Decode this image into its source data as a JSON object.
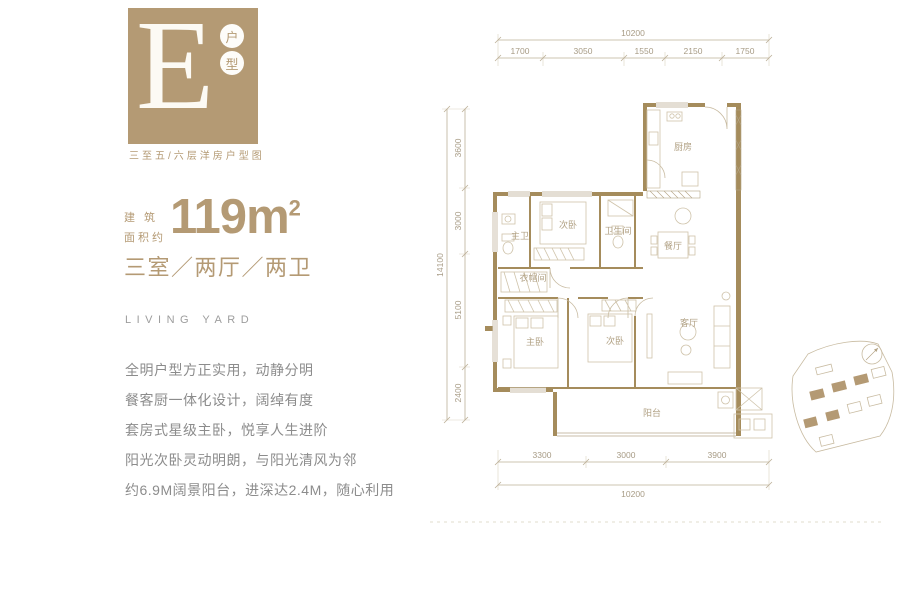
{
  "brand": {
    "letter": "E",
    "type_chars": [
      "户",
      "型"
    ],
    "subtitle": "三至五/六层洋房户型图"
  },
  "summary": {
    "area_prefix_line1": "建 筑",
    "area_prefix_line2": "面积约",
    "area_value": "119",
    "area_unit": "m",
    "area_sup": "2",
    "layout": "三室／两厅／两卫",
    "english": "LIVING YARD"
  },
  "features": [
    "全明户型方正实用，动静分明",
    "餐客厨一体化设计，阔绰有度",
    "套房式星级主卧，悦享人生进阶",
    "阳光次卧灵动明朗，与阳光清风为邻",
    "约6.9M阔景阳台，进深达2.4M，随心利用"
  ],
  "plan": {
    "rooms": {
      "kitchen": "厨房",
      "bedroom_top": "次卧",
      "master_bath": "主卫",
      "bath": "卫生间",
      "dining": "餐厅",
      "cloakroom": "衣帽间",
      "master_bedroom": "主卧",
      "bedroom_bottom": "次卧",
      "living": "客厅",
      "balcony": "阳台"
    },
    "dims": {
      "top_total": "10200",
      "top_segments": [
        "1700",
        "3050",
        "1550",
        "2150",
        "1750"
      ],
      "left_total": "14100",
      "left_segments": [
        "3600",
        "3000",
        "5100",
        "2400"
      ],
      "bottom_segments": [
        "3300",
        "3000",
        "3900"
      ],
      "bottom_total": "10200"
    }
  },
  "colors": {
    "brand_tan": "#b49a74",
    "wall_tan": "#a58c5c",
    "line_light": "#c8bba1",
    "text_gray": "#8c8c8c"
  }
}
